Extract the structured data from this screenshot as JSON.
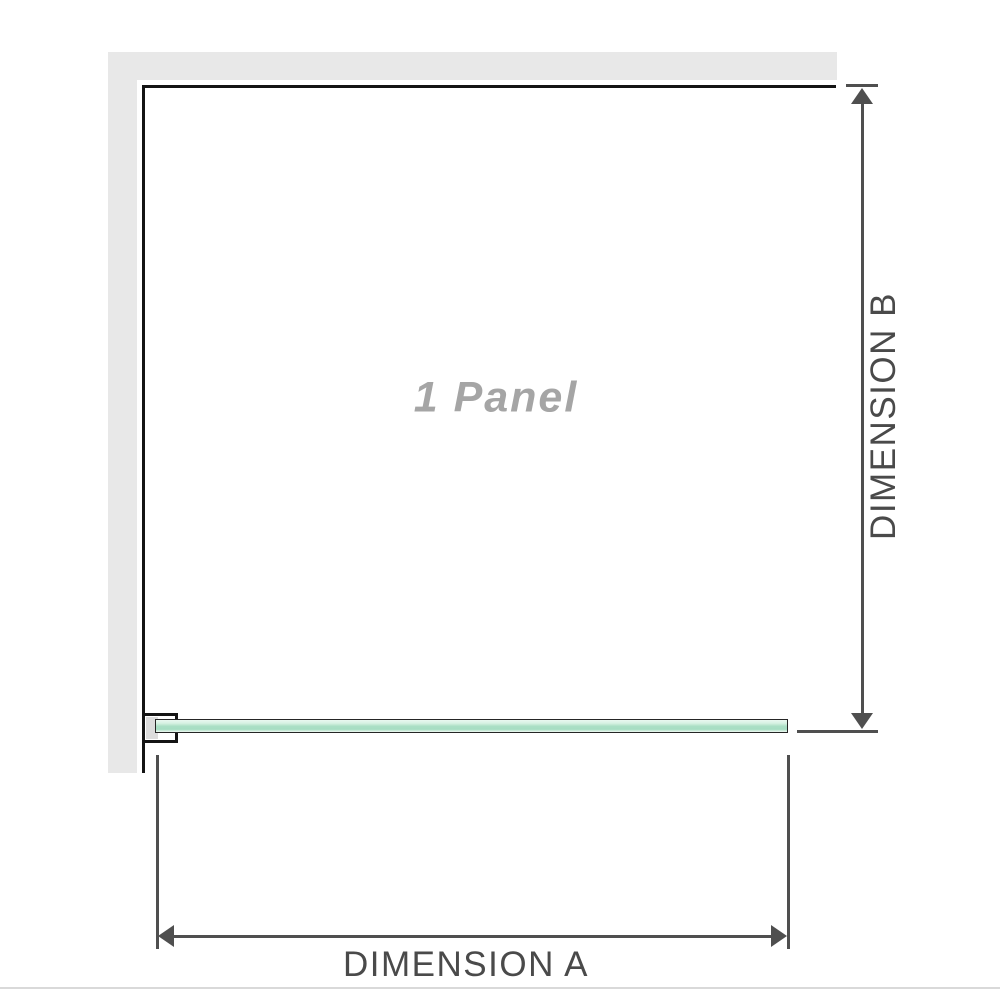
{
  "diagram": {
    "panel_label": "1 Panel",
    "dimension_a_label": "DIMENSION A",
    "dimension_b_label": "DIMENSION B"
  },
  "colors": {
    "wall": "#e8e8e8",
    "ink": "#141414",
    "dim": "#4f4f4f",
    "label_text": "#4a4a4a",
    "panel_text": "#a5a5a5",
    "glass_light": "#d6f1e2",
    "glass_mid": "#a6ddc2",
    "rule": "#d9d9d9"
  }
}
